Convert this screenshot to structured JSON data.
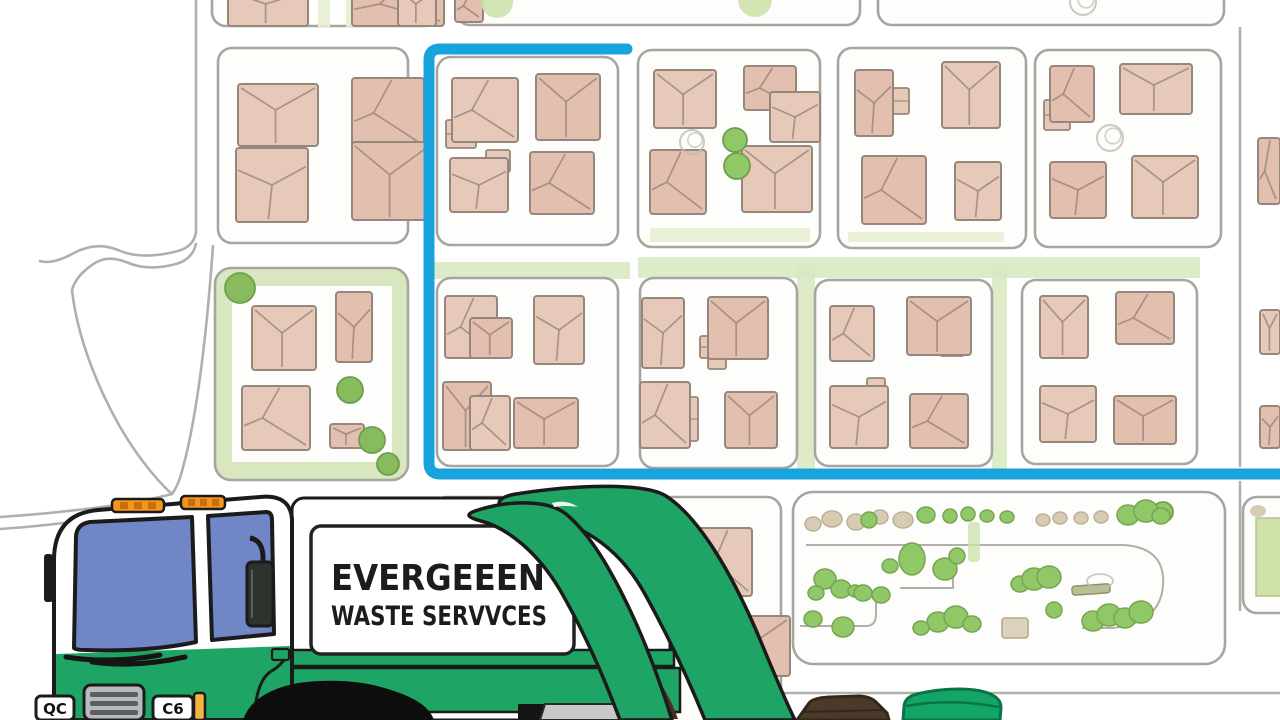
{
  "scene": {
    "width": 1280,
    "height": 720,
    "description": "cartoon garbage truck in front of a neighborhood street map with highlighted collection route"
  },
  "palette": {
    "route_blue": "#18a3dd",
    "road_gray": "#b0afa9",
    "block_border": "#a6a5a0",
    "block_fill": "#fdfdfb",
    "house_fill": "#e7c9ba",
    "house_fill_alt": "#e2bfae",
    "house_line": "#97867b",
    "green_band": "#d8e7c0",
    "green_pale": "#e6efd2",
    "tree_green": "#90c868",
    "tree_dark": "#86bb5e",
    "tree_pale": "#cde2ab",
    "scribble_gray": "#bdbcb6",
    "truck_green": "#1ea565",
    "window_blue": "#7186c6",
    "outline": "#1b1b1b",
    "light_orange": "#f5941f",
    "light_orange_dark": "#c76f0e",
    "grille_gray": "#b6babf",
    "grille_slat": "#5a5e63",
    "bin_brown": "#4b3a2a",
    "bin_brown_dark": "#33271b",
    "bin_green": "#12a566",
    "bin_green_dark": "#0a7347",
    "wheel_black": "#0d0d0d"
  },
  "truck": {
    "sign": {
      "line1": "EVERGEEEN",
      "line2": "WASTE SERVVCES"
    },
    "plates": {
      "left": "QC",
      "right": "C6"
    }
  },
  "bins": {
    "left": "brown waste bin",
    "right": "green recycling bin"
  },
  "map": {
    "route": {
      "d": "M627,49 L440,49 Q429,49 429,60 L429,463 Q429,474 440,474 L1288,474",
      "width": 11
    },
    "roads": [
      "M196,0 L196,232",
      "M196,232 Q194,248 174,252 Q140,260 118,250 Q96,241 74,253 Q52,265 40,261",
      "M196,244 Q192,261 172,265 Q146,271 126,262 Q106,254 92,265 Q76,276 72,290",
      "M72,290 C78,345 108,418 148,468 C156,478 164,487 172,494",
      "M213,246 C207,330 197,422 180,478 Q177,487 172,494",
      "M172,494 C130,505 60,513 0,517",
      "M180,502 C140,514 60,525 0,529",
      "M1240,28 L1240,466",
      "M1240,482 L1240,610",
      "M640,693 L1280,693",
      "M775,671 L775,693"
    ],
    "strips_under": [
      [
        427,
        262,
        203,
        17
      ],
      [
        638,
        257,
        562,
        21
      ],
      [
        797,
        265,
        18,
        207
      ],
      [
        992,
        265,
        15,
        207
      ]
    ],
    "strips_inner": [
      [
        848,
        232,
        156,
        10
      ],
      [
        650,
        228,
        160,
        14
      ],
      [
        318,
        -2,
        12,
        29
      ],
      [
        346,
        -2,
        12,
        29
      ]
    ],
    "blocks": [
      {
        "x": 212,
        "y": -45,
        "w": 226,
        "h": 71,
        "kind": "normal"
      },
      {
        "x": 456,
        "y": -45,
        "w": 404,
        "h": 70,
        "kind": "normal"
      },
      {
        "x": 878,
        "y": -42,
        "w": 346,
        "h": 67,
        "kind": "normal"
      },
      {
        "x": 218,
        "y": 48,
        "w": 190,
        "h": 195,
        "kind": "normal"
      },
      {
        "x": 437,
        "y": 57,
        "w": 181,
        "h": 188,
        "kind": "normal"
      },
      {
        "x": 638,
        "y": 50,
        "w": 182,
        "h": 197,
        "kind": "normal"
      },
      {
        "x": 838,
        "y": 48,
        "w": 188,
        "h": 200,
        "kind": "normal"
      },
      {
        "x": 1035,
        "y": 50,
        "w": 186,
        "h": 197,
        "kind": "normal"
      },
      {
        "x": 215,
        "y": 268,
        "w": 193,
        "h": 212,
        "kind": "green",
        "inner": [
          232,
          286,
          160,
          176
        ]
      },
      {
        "x": 437,
        "y": 278,
        "w": 181,
        "h": 188,
        "kind": "normal"
      },
      {
        "x": 640,
        "y": 278,
        "w": 157,
        "h": 190,
        "kind": "normal"
      },
      {
        "x": 815,
        "y": 280,
        "w": 177,
        "h": 186,
        "kind": "normal"
      },
      {
        "x": 1022,
        "y": 280,
        "w": 175,
        "h": 184,
        "kind": "normal"
      },
      {
        "x": 433,
        "y": 497,
        "w": 348,
        "h": 230,
        "kind": "normal"
      },
      {
        "x": 793,
        "y": 492,
        "w": 432,
        "h": 172,
        "kind": "park"
      },
      {
        "x": 1243,
        "y": 497,
        "w": 60,
        "h": 116,
        "kind": "normal"
      }
    ],
    "houses": [
      [
        228,
        -12,
        80,
        38,
        0
      ],
      [
        352,
        -18,
        92,
        44,
        1
      ],
      [
        398,
        -12,
        38,
        38,
        0
      ],
      [
        455,
        -10,
        28,
        32,
        1
      ],
      [
        238,
        84,
        80,
        62,
        0
      ],
      [
        352,
        78,
        72,
        70,
        1
      ],
      [
        236,
        148,
        72,
        74,
        2
      ],
      [
        352,
        142,
        80,
        78,
        0
      ],
      [
        452,
        78,
        66,
        64,
        1
      ],
      [
        536,
        74,
        64,
        66,
        0
      ],
      [
        450,
        158,
        58,
        54,
        2
      ],
      [
        530,
        152,
        64,
        62,
        1
      ],
      [
        654,
        70,
        62,
        58,
        0
      ],
      [
        744,
        66,
        52,
        44,
        1
      ],
      [
        770,
        92,
        50,
        50,
        2
      ],
      [
        650,
        150,
        56,
        64,
        1
      ],
      [
        742,
        146,
        70,
        66,
        0
      ],
      [
        855,
        70,
        38,
        66,
        2
      ],
      [
        942,
        62,
        58,
        66,
        0
      ],
      [
        862,
        156,
        64,
        68,
        1
      ],
      [
        955,
        162,
        46,
        58,
        2
      ],
      [
        1050,
        66,
        44,
        56,
        1
      ],
      [
        1120,
        64,
        72,
        50,
        0
      ],
      [
        1050,
        162,
        56,
        56,
        2
      ],
      [
        1132,
        156,
        66,
        62,
        0
      ],
      [
        1258,
        138,
        22,
        66,
        1
      ],
      [
        1260,
        310,
        20,
        44,
        0
      ],
      [
        1260,
        406,
        20,
        42,
        2
      ],
      [
        252,
        306,
        64,
        64,
        0
      ],
      [
        336,
        292,
        36,
        70,
        2
      ],
      [
        242,
        386,
        68,
        64,
        1
      ],
      [
        330,
        424,
        34,
        24,
        0
      ],
      [
        445,
        296,
        52,
        62,
        1
      ],
      [
        470,
        318,
        42,
        40,
        0
      ],
      [
        534,
        296,
        50,
        68,
        2
      ],
      [
        443,
        382,
        48,
        68,
        0
      ],
      [
        470,
        396,
        40,
        54,
        1
      ],
      [
        514,
        398,
        64,
        50,
        0
      ],
      [
        642,
        298,
        42,
        70,
        2
      ],
      [
        708,
        297,
        60,
        62,
        0
      ],
      [
        640,
        382,
        50,
        66,
        1
      ],
      [
        725,
        392,
        52,
        56,
        0
      ],
      [
        830,
        306,
        44,
        55,
        1
      ],
      [
        907,
        297,
        64,
        58,
        0
      ],
      [
        830,
        386,
        58,
        62,
        2
      ],
      [
        910,
        394,
        58,
        54,
        1
      ],
      [
        1040,
        296,
        48,
        62,
        0
      ],
      [
        1116,
        292,
        58,
        52,
        1
      ],
      [
        1040,
        386,
        56,
        56,
        2
      ],
      [
        1114,
        396,
        62,
        48,
        0
      ],
      [
        698,
        528,
        54,
        68,
        1
      ],
      [
        726,
        616,
        64,
        60,
        0
      ]
    ],
    "sheds": [
      [
        368,
        118,
        30,
        32
      ],
      [
        446,
        120,
        30,
        28
      ],
      [
        486,
        150,
        24,
        22
      ],
      [
        893,
        88,
        16,
        26
      ],
      [
        1044,
        100,
        26,
        30
      ],
      [
        700,
        336,
        18,
        22
      ],
      [
        940,
        332,
        24,
        24
      ],
      [
        867,
        378,
        18,
        28
      ],
      [
        708,
        347,
        18,
        22
      ],
      [
        688,
        397,
        10,
        44
      ]
    ],
    "trees": [
      {
        "x": 497,
        "y": 2,
        "r": 16,
        "kind": "pale"
      },
      {
        "x": 755,
        "y": 0,
        "r": 17,
        "kind": "pale"
      },
      {
        "x": 1083,
        "y": 2,
        "r": 13,
        "kind": "scribble"
      },
      {
        "x": 735,
        "y": 140,
        "r": 12,
        "kind": "green"
      },
      {
        "x": 737,
        "y": 166,
        "r": 13,
        "kind": "green"
      },
      {
        "x": 692,
        "y": 142,
        "r": 12,
        "kind": "scribble"
      },
      {
        "x": 1110,
        "y": 138,
        "r": 13,
        "kind": "scribble"
      },
      {
        "x": 240,
        "y": 288,
        "r": 15,
        "kind": "dark"
      },
      {
        "x": 350,
        "y": 390,
        "r": 13,
        "kind": "dark"
      },
      {
        "x": 372,
        "y": 440,
        "r": 13,
        "kind": "dark"
      },
      {
        "x": 388,
        "y": 464,
        "r": 11,
        "kind": "dark"
      },
      {
        "x": 1163,
        "y": 512,
        "r": 10,
        "kind": "green"
      }
    ],
    "park": {
      "paths": [
        "M806,545 H1124 Q1166,548 1163,586 Q1160,623 1112,628 H1082",
        "M800,626 H866 Q876,626 876,614 V602",
        "M900,588 H953 V564"
      ],
      "pale_strip": [
        968,
        522,
        12,
        40
      ],
      "tan_square": [
        1002,
        618,
        26,
        20
      ],
      "bench": {
        "rect": [
          1072,
          585,
          38,
          9
        ],
        "loop": [
          1100,
          581,
          13,
          7
        ]
      },
      "blobs": [
        [
          813,
          524,
          8,
          7,
          "tan"
        ],
        [
          832,
          519,
          10,
          8,
          "tan"
        ],
        [
          856,
          522,
          9,
          8,
          "tan"
        ],
        [
          880,
          517,
          8,
          7,
          "tan"
        ],
        [
          903,
          520,
          10,
          8,
          "tan"
        ],
        [
          1043,
          520,
          7,
          6,
          "tan"
        ],
        [
          1060,
          518,
          7,
          6,
          "tan"
        ],
        [
          1081,
          518,
          7,
          6,
          "tan"
        ],
        [
          1101,
          517,
          7,
          6,
          "tan"
        ],
        [
          869,
          520,
          8,
          8,
          "green"
        ],
        [
          926,
          515,
          9,
          8,
          "green"
        ],
        [
          950,
          516,
          7,
          7,
          "green"
        ],
        [
          968,
          514,
          7,
          7,
          "green"
        ],
        [
          987,
          516,
          7,
          6,
          "green"
        ],
        [
          1007,
          517,
          7,
          6,
          "green"
        ],
        [
          1128,
          515,
          11,
          10,
          "green"
        ],
        [
          1146,
          511,
          12,
          11,
          "green"
        ],
        [
          1161,
          516,
          9,
          8,
          "green"
        ],
        [
          912,
          559,
          13,
          16,
          "green"
        ],
        [
          890,
          566,
          8,
          7,
          "green"
        ],
        [
          825,
          579,
          11,
          10,
          "green"
        ],
        [
          841,
          589,
          10,
          9,
          "green"
        ],
        [
          816,
          593,
          8,
          7,
          "green"
        ],
        [
          855,
          591,
          7,
          6,
          "green"
        ],
        [
          863,
          593,
          9,
          8,
          "green"
        ],
        [
          881,
          595,
          9,
          8,
          "green"
        ],
        [
          945,
          569,
          12,
          11,
          "green"
        ],
        [
          957,
          556,
          8,
          8,
          "green"
        ],
        [
          1020,
          584,
          9,
          8,
          "green"
        ],
        [
          1034,
          579,
          12,
          11,
          "green"
        ],
        [
          1049,
          577,
          12,
          11,
          "green"
        ],
        [
          1054,
          610,
          8,
          8,
          "green"
        ],
        [
          938,
          622,
          11,
          10,
          "green"
        ],
        [
          956,
          617,
          12,
          11,
          "green"
        ],
        [
          972,
          624,
          9,
          8,
          "green"
        ],
        [
          921,
          628,
          8,
          7,
          "green"
        ],
        [
          1093,
          621,
          11,
          10,
          "green"
        ],
        [
          1109,
          615,
          12,
          11,
          "green"
        ],
        [
          1125,
          618,
          11,
          10,
          "green"
        ],
        [
          1141,
          612,
          12,
          11,
          "green"
        ],
        [
          813,
          619,
          9,
          8,
          "green"
        ],
        [
          843,
          627,
          11,
          10,
          "green"
        ]
      ]
    },
    "side_green_rect": [
      1256,
      518,
      26,
      78
    ],
    "side_tan_blob": [
      1250,
      505,
      16,
      12
    ]
  }
}
